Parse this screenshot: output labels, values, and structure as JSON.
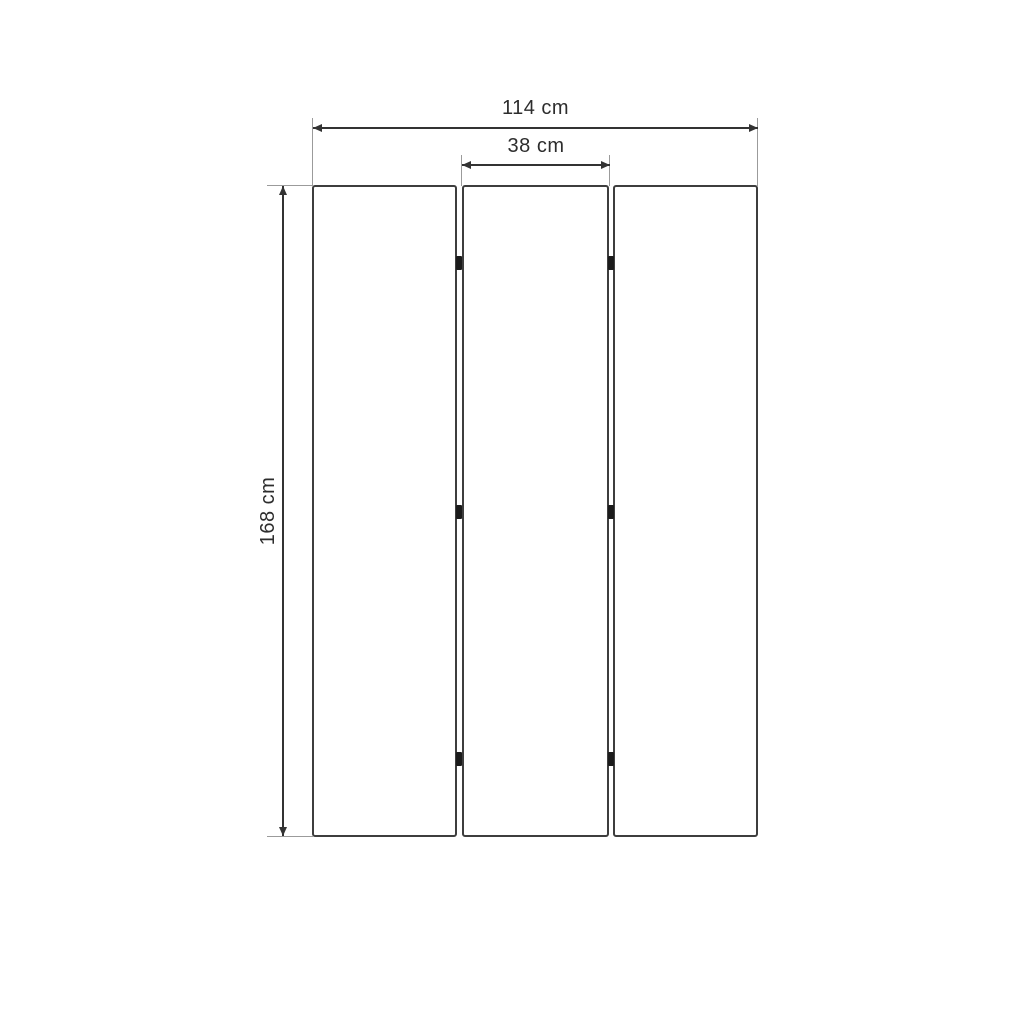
{
  "diagram": {
    "labels": {
      "total_width": "114 cm",
      "panel_width": "38 cm",
      "height": "168 cm"
    },
    "panel_count": 3,
    "hinge_rows": 3,
    "colors": {
      "background": "#ffffff",
      "dimension_line": "#333333",
      "extension_line": "#9b9b9b",
      "panel_border": "#3e3e3e",
      "hinge": "#1b1b1b",
      "label_text": "#2d2d2d"
    }
  }
}
